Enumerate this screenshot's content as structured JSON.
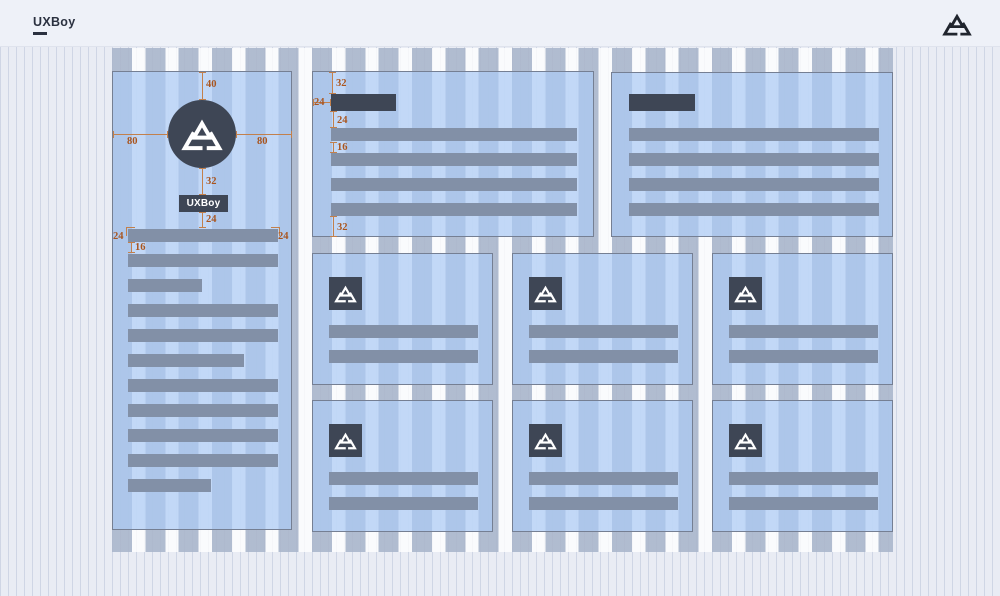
{
  "header": {
    "brand": "UXBoy",
    "logo": "triangle-logo"
  },
  "colors": {
    "annotation": "#a9551f",
    "annotation_line": "#c2804c",
    "dark": "#3e4655",
    "bar_fill": "#8290a7",
    "card_fill": "rgba(172,203,244,0.72)",
    "grid_column": "rgba(75,100,145,0.42)",
    "header_bg": "#eef1f8",
    "header_text": "#2b3140",
    "canvas_bg": "#e9ecf4",
    "card_border": "#757f93",
    "logo_dark": "#20252e"
  },
  "artboard": {
    "grid": {
      "columns_visible": true,
      "column_width_px": 20,
      "gutter_px": 13
    },
    "profile_card": {
      "chip_label": "UXBoy",
      "icon": "triangle-logo",
      "measurements": {
        "avatar_top": "40",
        "avatar_left": "80",
        "avatar_right": "80",
        "avatar_to_chip": "32",
        "chip_to_text": "24",
        "text_left": "24",
        "text_right": "24",
        "line_spacing": "16"
      },
      "bars": [
        100,
        100,
        49,
        100,
        100,
        77,
        100,
        100,
        100,
        100,
        55
      ]
    },
    "article_cards": [
      {
        "measurements": {
          "title_top": "32",
          "title_left": "24",
          "title_to_text": "24",
          "line_spacing": "16",
          "text_bottom": "32"
        },
        "bars": [
          100,
          100,
          100,
          100
        ]
      },
      {
        "bars": [
          100,
          100,
          100,
          100
        ]
      }
    ],
    "feature_cards": [
      {
        "icon": "triangle-logo",
        "bars": [
          100,
          100
        ]
      },
      {
        "icon": "triangle-logo",
        "bars": [
          100,
          100
        ]
      },
      {
        "icon": "triangle-logo",
        "bars": [
          100,
          100
        ]
      },
      {
        "icon": "triangle-logo",
        "bars": [
          100,
          100
        ]
      },
      {
        "icon": "triangle-logo",
        "bars": [
          100,
          100
        ]
      },
      {
        "icon": "triangle-logo",
        "bars": [
          100,
          100
        ]
      }
    ]
  }
}
